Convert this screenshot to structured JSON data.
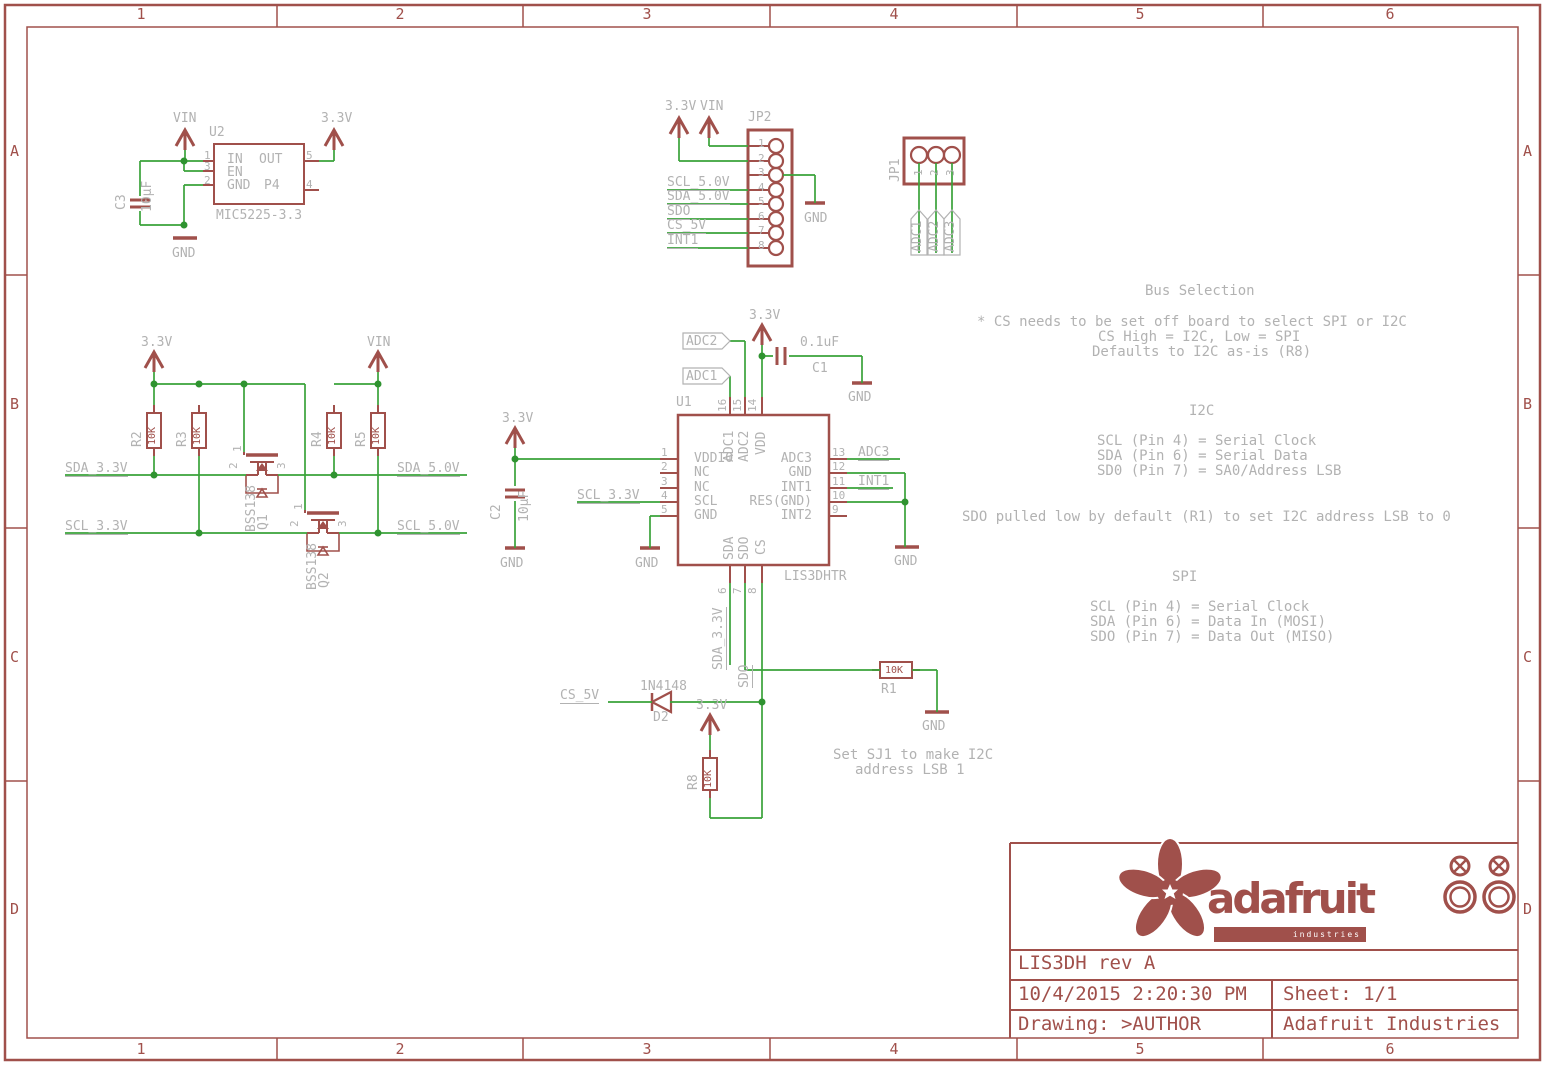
{
  "frame": {
    "cols": [
      "1",
      "2",
      "3",
      "4",
      "5",
      "6"
    ],
    "rows": [
      "A",
      "B",
      "C",
      "D"
    ]
  },
  "power": {
    "v33": "3.3V",
    "vin": "VIN",
    "gnd": "GND"
  },
  "regulator": {
    "ref": "U2",
    "part": "MIC5225-3.3",
    "cap_ref": "C3",
    "cap_val": "10µF",
    "num_in": "1",
    "num_en": "3",
    "num_gnd": "2",
    "num_out": "5",
    "num_p4": "4",
    "name_in": "IN",
    "name_out": "OUT",
    "name_en": "EN",
    "name_gnd": "GND",
    "name_p4": "P4"
  },
  "jp2": {
    "ref": "JP2",
    "pins": [
      "1",
      "2",
      "3",
      "4",
      "5",
      "6",
      "7",
      "8"
    ],
    "net_scl": "SCL_5.0V",
    "net_sda": "SDA_5.0V",
    "net_sdo": "SDO",
    "net_cs": "CS_5V",
    "net_int": "INT1"
  },
  "jp1": {
    "ref": "JP1",
    "pins": [
      "1",
      "2",
      "3"
    ],
    "nets": [
      "ADC1",
      "ADC2",
      "ADC3"
    ]
  },
  "shifter": {
    "r2": "R2",
    "r3": "R3",
    "r4": "R4",
    "r5": "R5",
    "res_val": "10K",
    "q_part": "BSS138",
    "q1": "Q1",
    "q2": "Q2",
    "p1": "1",
    "p2": "2",
    "p3": "3",
    "net_sda33": "SDA_3.3V",
    "net_sda50": "SDA_5.0V",
    "net_scl33": "SCL_3.3V",
    "net_scl50": "SCL_5.0V"
  },
  "u1": {
    "ref": "U1",
    "part": "LIS3DHTR",
    "left_nums": [
      "1",
      "2",
      "3",
      "4",
      "5"
    ],
    "left_names": [
      "VDDIO",
      "NC",
      "NC",
      "SCL",
      "GND"
    ],
    "right_nums": [
      "13",
      "12",
      "11",
      "10",
      "9"
    ],
    "right_names": [
      "ADC3",
      "GND",
      "INT1",
      "RES(GND)",
      "INT2"
    ],
    "top_nums": [
      "16",
      "15",
      "14"
    ],
    "top_names": [
      "ADC1",
      "ADC2",
      "VDD"
    ],
    "bot_nums": [
      "6",
      "7",
      "8"
    ],
    "bot_names": [
      "SDA",
      "SDO",
      "CS"
    ],
    "net_adc1": "ADC1",
    "net_adc2": "ADC2",
    "net_adc3": "ADC3",
    "net_int1": "INT1",
    "net_scl33": "SCL_3.3V",
    "c1_ref": "C1",
    "c1_val": "0.1uF",
    "c2_ref": "C2",
    "c2_val": "10µF"
  },
  "lower": {
    "net_cs5": "CS_5V",
    "d2_ref": "D2",
    "d2_part": "1N4148",
    "r1_ref": "R1",
    "r1_val": "10K",
    "r8_ref": "R8",
    "r8_val": "10K",
    "net_sda33": "SDA_3.3V",
    "net_sdo": "SDO",
    "note1": "Set SJ1 to make I2C",
    "note2": "address LSB 1"
  },
  "notes": {
    "bus_title": "Bus Selection",
    "bus1": "* CS needs to be set off board to select SPI or I2C",
    "bus2": "CS High = I2C, Low = SPI",
    "bus3": "Defaults to I2C as-is (R8)",
    "i2c_title": "I2C",
    "i2c1": "SCL (Pin 4) = Serial Clock",
    "i2c2": "SDA (Pin 6) = Serial Data",
    "i2c3": "SD0 (Pin 7) = SA0/Address LSB",
    "sdo_note": "SDO pulled low by default (R1) to set I2C address LSB to 0",
    "spi_title": "SPI",
    "spi1": "SCL (Pin 4) = Serial Clock",
    "spi2": "SDA (Pin 6) = Data In (MOSI)",
    "spi3": "SDO (Pin 7) = Data Out (MISO)"
  },
  "titleblock": {
    "wordmark": "adafruit",
    "wordmark_sub": "industries",
    "title": "LIS3DH rev A",
    "date": "10/4/2015 2:20:30 PM",
    "sheet": "Sheet: 1/1",
    "drawing": "Drawing: >AUTHOR",
    "company": "Adafruit Industries"
  }
}
